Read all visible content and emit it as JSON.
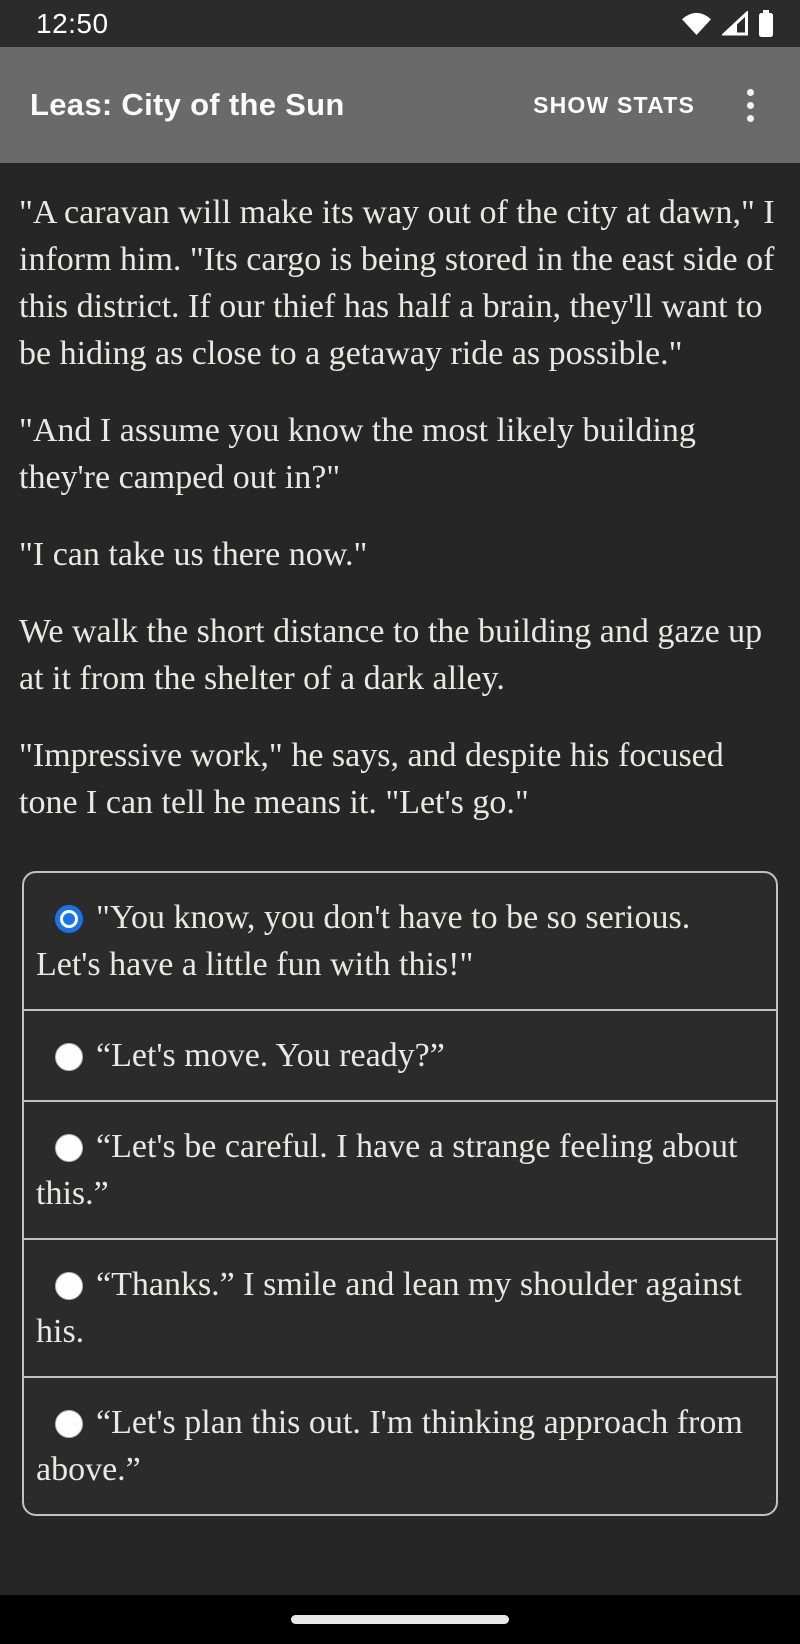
{
  "status_bar": {
    "time": "12:50",
    "icons": [
      "wifi-icon",
      "cellular-signal-icon",
      "battery-icon"
    ]
  },
  "app_bar": {
    "title": "Leas: City of the Sun",
    "action_label": "SHOW STATS",
    "overflow_icon": "kebab-menu-icon"
  },
  "story": {
    "paragraphs": [
      "\"A caravan will make its way out of the city at dawn,\" I inform him. \"Its cargo is being stored in the east side of this district. If our thief has half a brain, they'll want to be hiding as close to a getaway ride as possible.\"",
      "\"And I assume you know the most likely building they're camped out in?\"",
      "\"I can take us there now.\"",
      "We walk the short distance to the building and gaze up at it from the shelter of a dark alley.",
      "\"Impressive work,\" he says, and despite his focused tone I can tell he means it. \"Let's go.\""
    ]
  },
  "choices": {
    "items": [
      {
        "label": "\"You know, you don't have to be so serious. Let's have a little fun with this!\"",
        "selected": true
      },
      {
        "label": "“Let's move. You ready?”",
        "selected": false
      },
      {
        "label": "“Let's be careful. I have a strange feeling about this.”",
        "selected": false
      },
      {
        "label": "“Thanks.” I smile and lean my shoulder against his.",
        "selected": false
      },
      {
        "label": "“Let's plan this out. I'm thinking approach from above.”",
        "selected": false
      }
    ]
  },
  "nav_bar": {
    "home_indicator": "home-pill"
  },
  "colors": {
    "status_bar_bg": "#2b2b2b",
    "app_bar_bg": "#6a6a6a",
    "page_bg": "#262626",
    "choice_box_bg": "#2b2b2b",
    "border": "#c2c2c2",
    "body_text": "#e8e8e6",
    "accent_blue": "#1a73e8",
    "nav_bar_bg": "#000000"
  }
}
